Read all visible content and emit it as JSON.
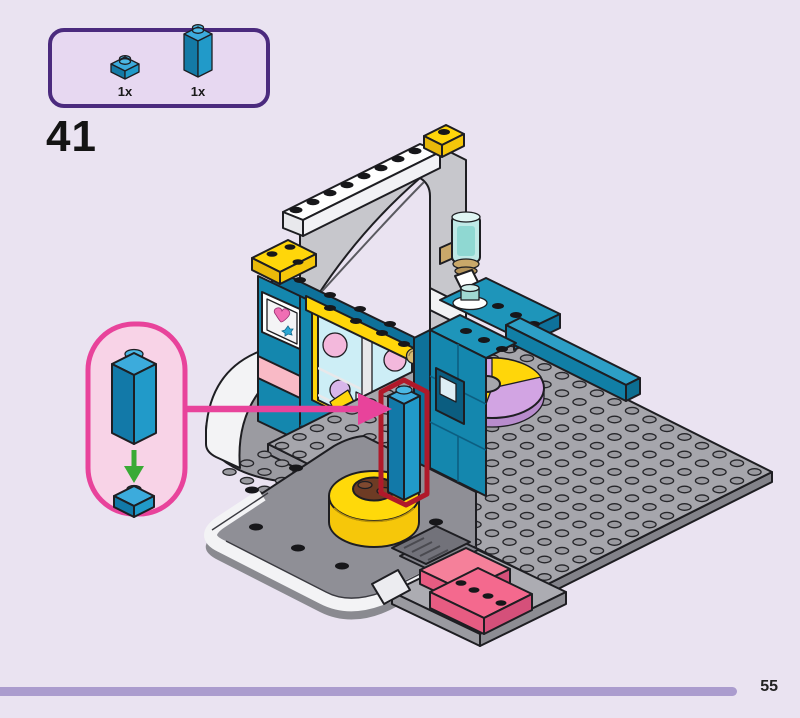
{
  "page": {
    "step_number": "41",
    "page_number": "55",
    "progress_percent": 92,
    "background": "#eae3f1"
  },
  "parts_panel": {
    "parts": [
      {
        "piece": "blue 1x1 plate",
        "count": "1x"
      },
      {
        "piece": "blue 1x1x3 brick",
        "count": "1x"
      }
    ]
  },
  "callout": {
    "piece": "blue 1x1x3 brick",
    "target": "blue 1x1 plate",
    "instruction_type": "place brick on marked position"
  },
  "colors": {
    "accent_pink": "#e8439b",
    "highlight_red": "#b0192a",
    "arrow_green": "#3aaa35",
    "brick_blue": "#219ac9",
    "wall_teal": "#1487ae",
    "panel_border": "#4b2a7e",
    "progress_bar": "#ab9cce"
  }
}
